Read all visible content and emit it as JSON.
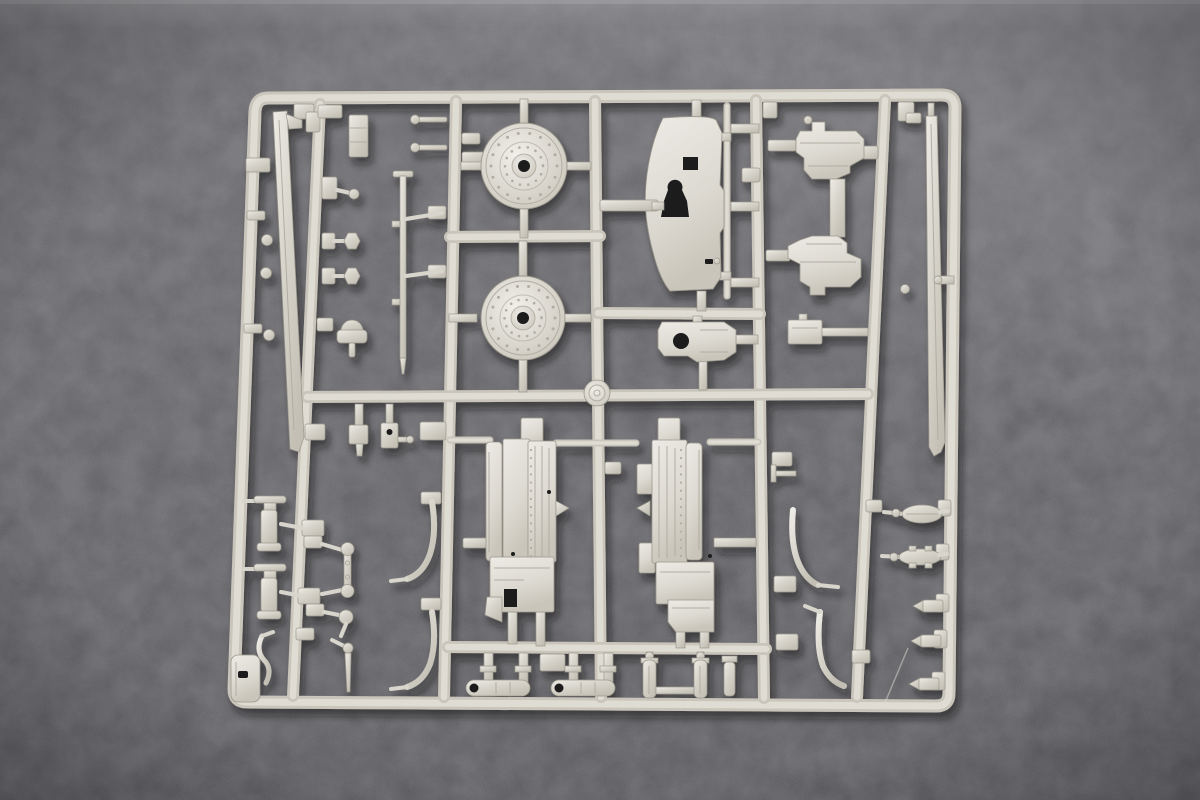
{
  "scene": {
    "type": "product-photograph",
    "subject": "injection-molded plastic model kit sprue (parts runner) laid on dark fabric",
    "sprue_material": "light grey styrene",
    "background_surface": "dark charcoal felt with fine texture",
    "lighting": "soft top light, lighter band at top edge, brighter patch upper-right, vignetted corners",
    "visible_text": ""
  },
  "palette": {
    "bg-top": "#7b7b7f",
    "bg-upper": "#57575b",
    "bg-mid": "#4a4a4e",
    "bg-low": "#3e3e42",
    "rail-base": "#c9c5bb",
    "rail-hi": "#dfdcd3",
    "plastic-light": "#eeece6",
    "plastic-mid": "#d8d5cc",
    "plastic-dark": "#b1ada2",
    "plastic-edge": "#9b978c",
    "hole": "#1a1a1d",
    "shadow": "#0b0b0d"
  },
  "inventory": {
    "frame": "rounded rectangular outer runner, slight perspective taper",
    "internal_runners_vertical": 5,
    "internal_runners_horizontal": 4,
    "parts": [
      {
        "name": "road-wheel",
        "count": 2
      },
      {
        "name": "hub-boss-disc",
        "count": 1
      },
      {
        "name": "gun-shield-plate",
        "count": 1
      },
      {
        "name": "turret-bracket",
        "count": 1
      },
      {
        "name": "mount-bracket",
        "count": 2
      },
      {
        "name": "recoil-breech-assembly",
        "count": 2
      },
      {
        "name": "barrel-half",
        "count": 2
      },
      {
        "name": "cleaning-rod",
        "count": 1
      },
      {
        "name": "shock-cylinder",
        "count": 2
      },
      {
        "name": "j-hook-rod",
        "count": 4
      },
      {
        "name": "hex-knob",
        "count": 2
      },
      {
        "name": "mushroom-vent",
        "count": 1
      },
      {
        "name": "dumbbell-link",
        "count": 1
      },
      {
        "name": "round-head-pin",
        "count": 2
      },
      {
        "name": "small-fitting-with-hole",
        "count": 1
      },
      {
        "name": "oval-lens",
        "count": 2
      },
      {
        "name": "cone-tipped-cylinder",
        "count": 3
      },
      {
        "name": "open-end-tube",
        "count": 2
      },
      {
        "name": "twin-cylinder-link",
        "count": 1
      },
      {
        "name": "corner-plate",
        "count": 1
      },
      {
        "name": "s-bend-rod",
        "count": 1
      },
      {
        "name": "ball-knob",
        "count": 1
      },
      {
        "name": "taper-pin",
        "count": 1
      },
      {
        "name": "gate-block",
        "count": 40
      }
    ]
  }
}
